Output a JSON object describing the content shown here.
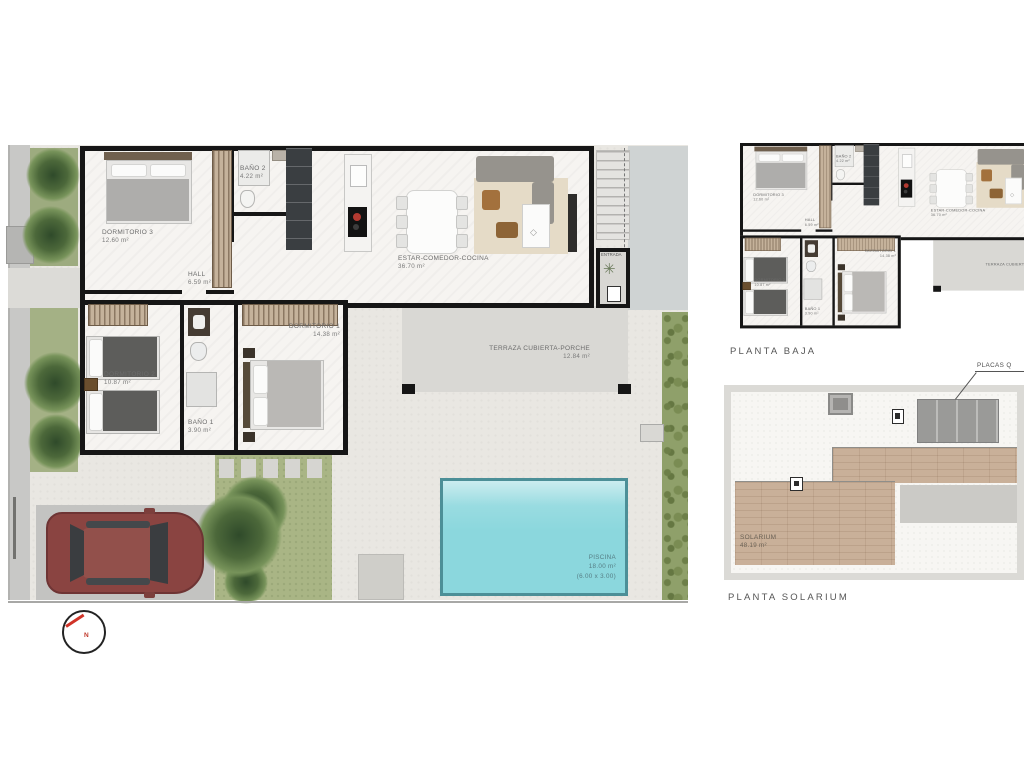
{
  "plans": {
    "main": {
      "rooms": {
        "dormitorio3": {
          "name": "DORMITORIO 3",
          "area": "12.60 m²"
        },
        "bano2": {
          "name": "BAÑO 2",
          "area": "4.22 m²"
        },
        "hall": {
          "name": "HALL",
          "area": "6.59 m²"
        },
        "estar": {
          "name": "ESTAR-COMEDOR-COCINA",
          "area": "36.70 m²"
        },
        "entrada": {
          "name": "ENTRADA"
        },
        "dormitorio2": {
          "name": "DORMITORIO 2",
          "area": "10.87 m²"
        },
        "bano1": {
          "name": "BAÑO 1",
          "area": "3.90 m²"
        },
        "dormitorio1": {
          "name": "DORMITORIO 1",
          "area": "14.38 m²"
        },
        "terraza": {
          "name": "TERRAZA CUBIERTA-PORCHE",
          "area": "12.84 m²"
        }
      },
      "pool": {
        "name": "PISCINA",
        "area": "18.00 m²",
        "dims": "(6.00 x 3.00)"
      },
      "compass_north": "N"
    },
    "planta_baja": {
      "caption": "PLANTA BAJA"
    },
    "solarium": {
      "caption": "PLANTA SOLARIUM",
      "room": {
        "name": "SOLARIUM",
        "area": "48.19 m²"
      },
      "callout": "PLACAS Q"
    }
  },
  "colors": {
    "wall": "#161616",
    "interior_floor": "#f6f4f1",
    "paving": "#e9e7e2",
    "terrace": "#d9d8d4",
    "pool_water": "#8bd7dd",
    "pool_edge": "#4c8f97",
    "lawn": "#a9b585",
    "hedge": "#8fa06a",
    "deck_wood": "#c9b099",
    "car_body": "#8a4441",
    "north_needle": "#d03328"
  }
}
